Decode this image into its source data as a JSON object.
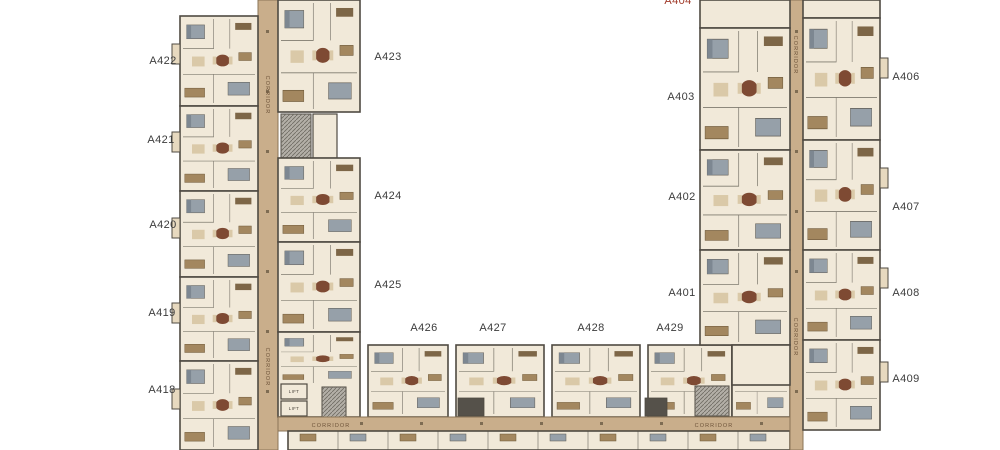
{
  "plan": {
    "corridor_label": "CORRIDOR",
    "lift_label": "LIFT",
    "units": {
      "a418": "A418",
      "a419": "A419",
      "a420": "A420",
      "a421": "A421",
      "a422": "A422",
      "a423": "A423",
      "a424": "A424",
      "a425": "A425",
      "a426": "A426",
      "a427": "A427",
      "a428": "A428",
      "a429": "A429",
      "a401": "A401",
      "a402": "A402",
      "a403": "A403",
      "a404_partial": "A404",
      "a406": "A406",
      "a407": "A407",
      "a408": "A408",
      "a409": "A409"
    },
    "colors": {
      "background": "#ffffff",
      "floor": "#f1e9d9",
      "floor_alt": "#e7d9bf",
      "wall": "#4f4a42",
      "corridor": "#c9ae8b",
      "corridor_edge": "#8a7457",
      "stair": "#b3afa7",
      "label_text": "#3c3c3c",
      "label_text_red": "#a03a2a",
      "corridor_text": "#6e543a",
      "furniture_brown": "#a3875f",
      "furniture_dark": "#7e4a33",
      "furniture_gray": "#96a0a9"
    }
  }
}
